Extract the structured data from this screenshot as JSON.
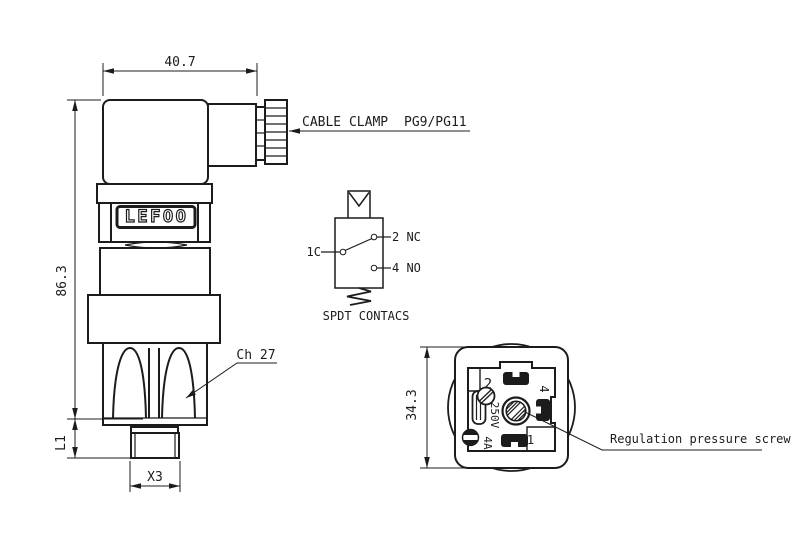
{
  "side_view": {
    "brand_label": "LEFOO",
    "dim_width": "40.7",
    "dim_height": "86.3",
    "dim_thread_length": "L1",
    "dim_thread": "X3",
    "hex_label": "Ch 27",
    "cable_clamp_label": "CABLE CLAMP",
    "cable_clamp_size": "PG9/PG11"
  },
  "schematic": {
    "terminal_common": "1C",
    "terminal_nc": "2 NC",
    "terminal_no": "4 NO",
    "caption": "SPDT CONTACS"
  },
  "connector_face": {
    "dim_size": "34.3",
    "terminal_2": "2",
    "terminal_4": "4",
    "terminal_1": "1",
    "voltage_rating": "250V",
    "current_rating": "4A",
    "regulation_label": "Regulation pressure screw"
  },
  "colors": {
    "line": "#1c1c1c",
    "background": "#ffffff"
  }
}
